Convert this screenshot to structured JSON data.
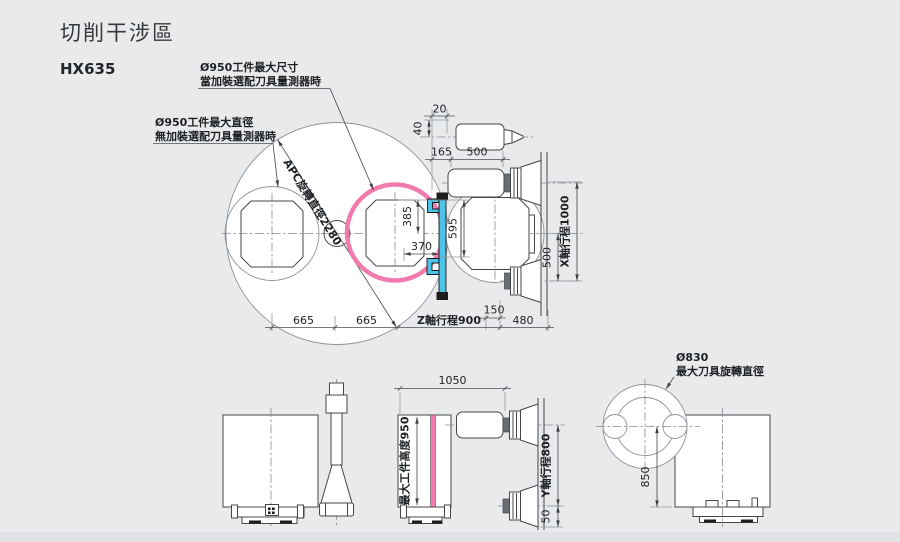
{
  "header": {
    "title": "切削干涉區",
    "model": "HX635"
  },
  "top_view": {
    "note_with_probe": {
      "line1": "Ø950工件最大尺寸",
      "line2": "當加裝選配刀具量測器時"
    },
    "note_without_probe": {
      "line1": "Ø950工件最大直徑",
      "line2": "無加裝選配刀具量測器時"
    },
    "apc_label": "APC旋轉直徑2280",
    "dims": {
      "d20": "20",
      "d40": "40",
      "d165": "165",
      "d500_top": "500",
      "d385": "385",
      "d370": "370",
      "d595": "595",
      "d665_a": "665",
      "d665_b": "665",
      "z_travel": "Z軸行程900",
      "d150": "150",
      "d480": "480",
      "x_travel": "X軸行程1000",
      "d500_x": "500"
    }
  },
  "front_view": {
    "dims": {
      "d1050": "1050",
      "workpiece_height": "最大工件高度950",
      "y_travel": "Y軸行程800",
      "d50": "50"
    }
  },
  "side_view": {
    "tool_note": {
      "line1": "Ø830",
      "line2": "最大刀具旋轉直徑"
    },
    "dims": {
      "d850": "850"
    }
  },
  "colors": {
    "background": "#e9eaec",
    "highlight_pink": "#f27bad",
    "device_blue": "#4cc4e8",
    "line": "#43474b"
  }
}
